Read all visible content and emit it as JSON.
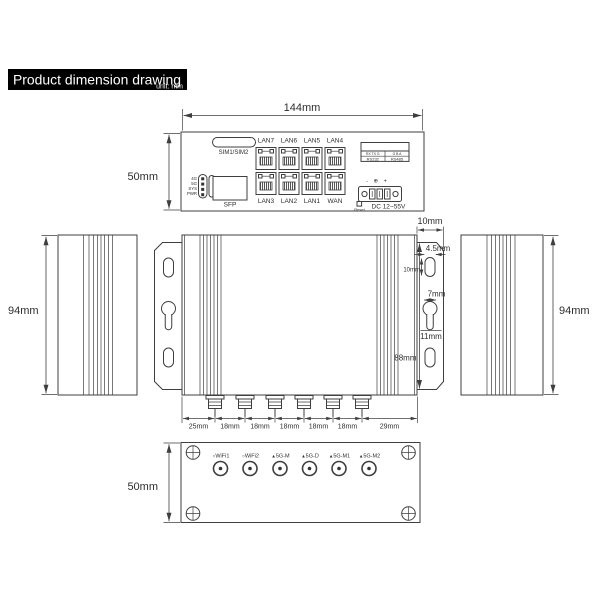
{
  "colors": {
    "line": "#3f3f3f",
    "title_bg": "#000000",
    "title_fg": "#ffffff"
  },
  "title": {
    "text": "Product dimension drawing",
    "unit": "unit:  mm"
  },
  "top_view": {
    "dim_width": "144mm",
    "dim_height": "50mm",
    "sim": "SIM1/SIM2",
    "leds": [
      "4G",
      "5G",
      "SYS",
      "PWR"
    ],
    "sfp": "SFP",
    "ports_top": [
      "LAN7",
      "LAN6",
      "LAN5",
      "LAN4"
    ],
    "ports_bottom": [
      "LAN3",
      "LAN2",
      "LAN1",
      "WAN"
    ],
    "serial": {
      "r1l": "RX TX G",
      "r1r": "G  B  A",
      "r2l": "RS232",
      "r2r": "RS485"
    },
    "polarity": "- ⊕ +",
    "dc": "DC 12~55V",
    "reset": "Reset"
  },
  "side_left": {
    "dim_height": "94mm"
  },
  "side_right": {
    "dim_height": "94mm"
  },
  "main_view": {
    "dim_ear_width": "10mm",
    "dim_slot_width": "4.5mm",
    "dim_slot_height": "10mm",
    "dim_keyhole_dia": "7mm",
    "dim_keyhole_len": "11mm",
    "dim_plate_height": "88mm",
    "spacings": [
      "25mm",
      "18mm",
      "18mm",
      "18mm",
      "18mm",
      "18mm",
      "29mm"
    ]
  },
  "bottom_view": {
    "dim_height": "50mm",
    "antennas": [
      {
        "marker": "○",
        "label": "WiFi1"
      },
      {
        "marker": "○",
        "label": "WiFi2"
      },
      {
        "marker": "▲",
        "label": "5G-M"
      },
      {
        "marker": "▲",
        "label": "5G-D"
      },
      {
        "marker": "▲",
        "label": "5G-M1"
      },
      {
        "marker": "▲",
        "label": "5G-M2"
      }
    ]
  }
}
